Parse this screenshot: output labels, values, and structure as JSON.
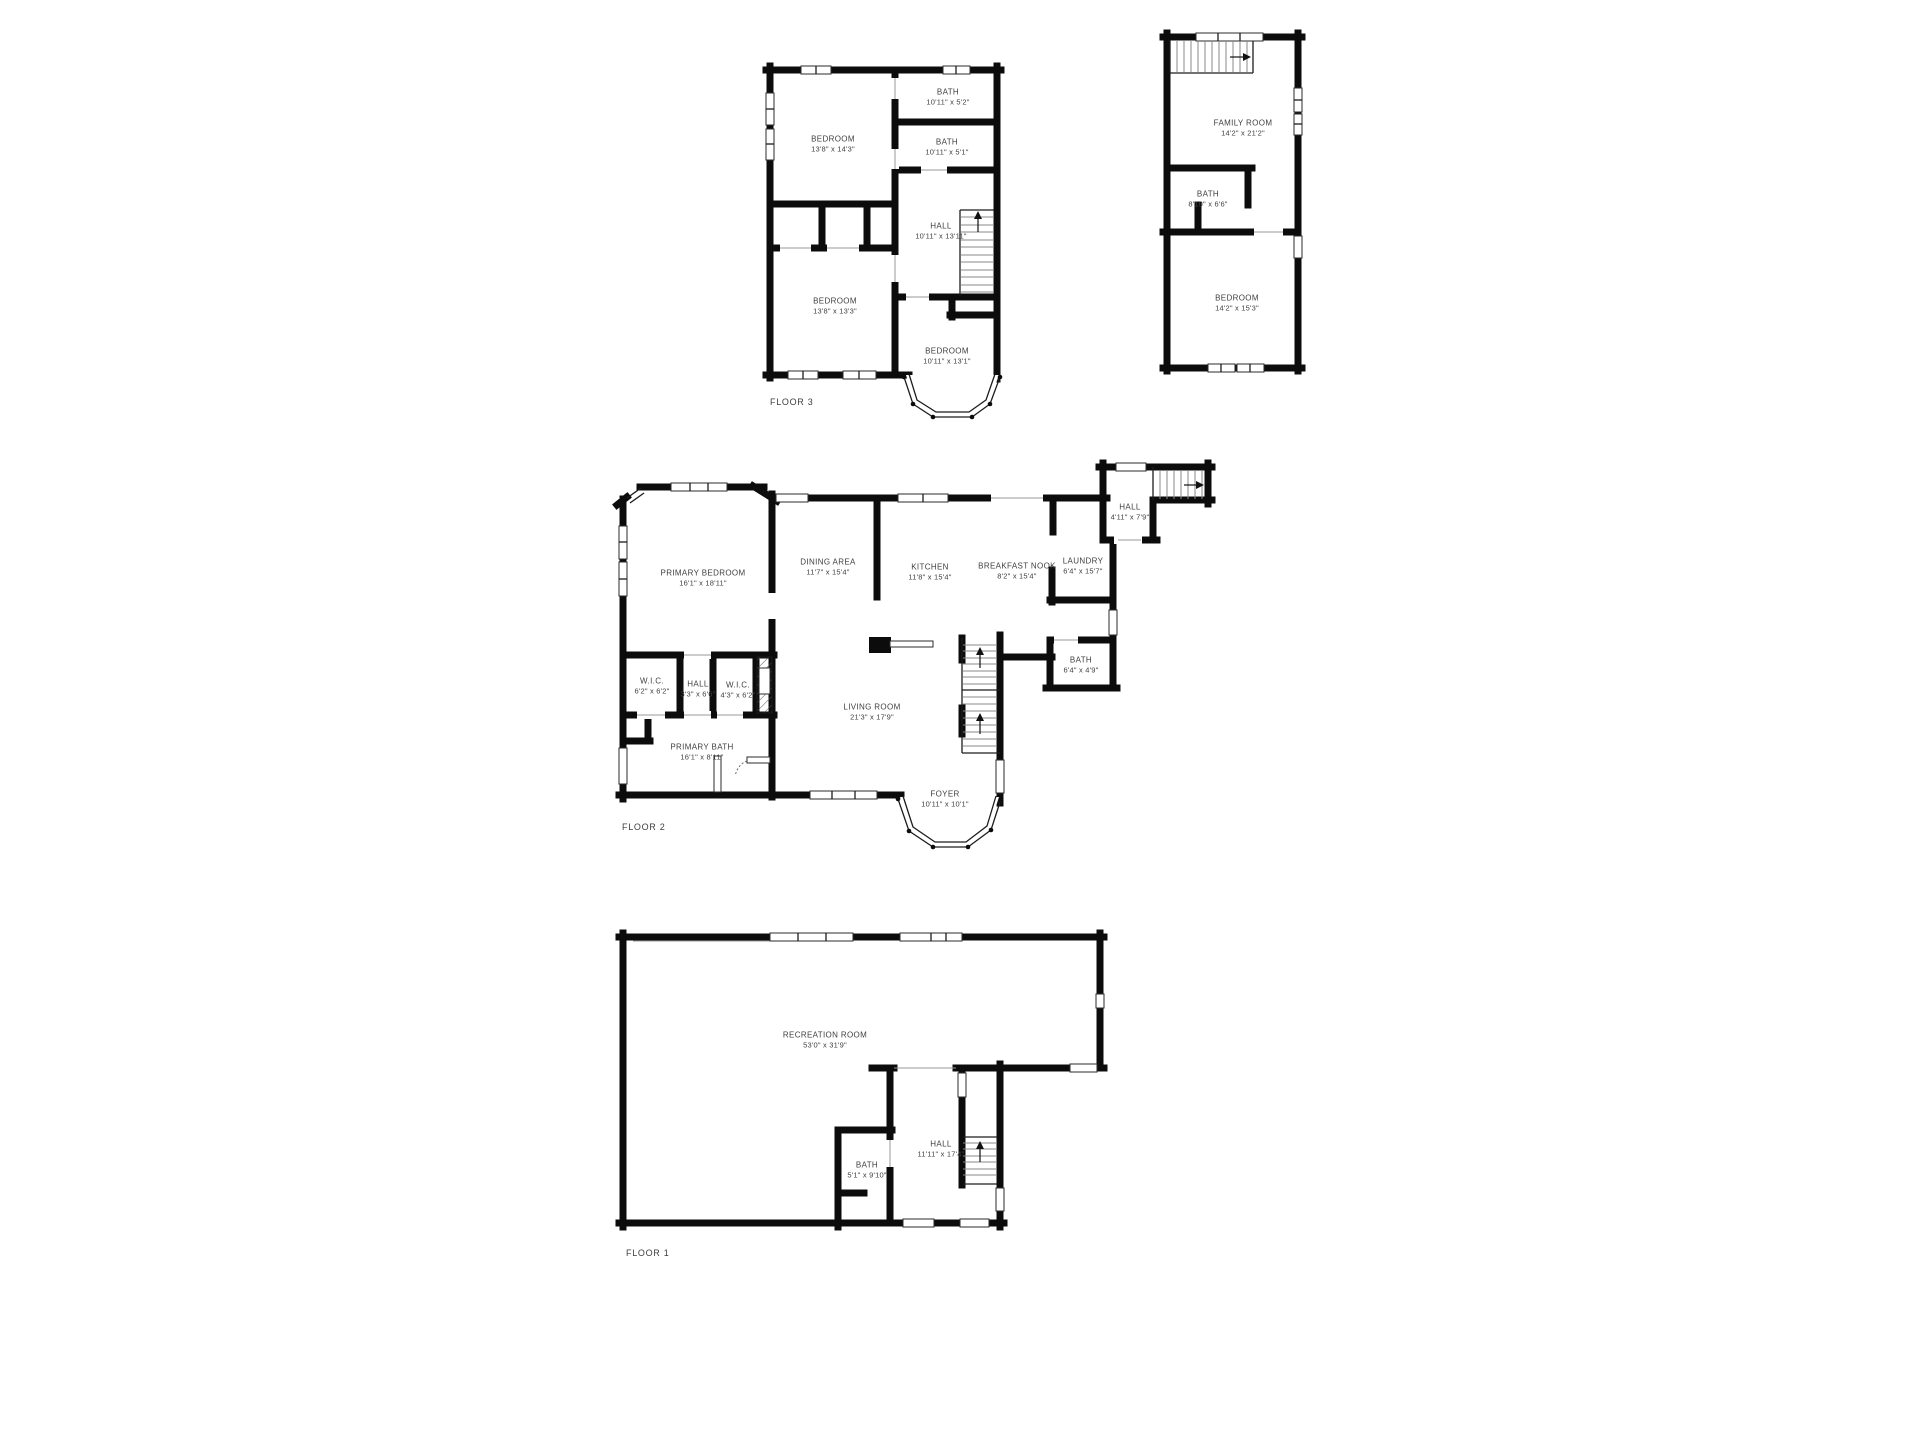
{
  "colors": {
    "background": "#ffffff",
    "walls": "#0c0c0c",
    "label_text": "#3f3f3f"
  },
  "floors": [
    {
      "title": "FLOOR 3",
      "rooms": [
        {
          "name": "BEDROOM",
          "dims": "13'8\" x 14'3\""
        },
        {
          "name": "BATH",
          "dims": "10'11\" x 5'2\""
        },
        {
          "name": "BATH",
          "dims": "10'11\" x 5'1\""
        },
        {
          "name": "HALL",
          "dims": "10'11\" x 13'11\""
        },
        {
          "name": "BEDROOM",
          "dims": "13'8\" x 13'3\""
        },
        {
          "name": "BEDROOM",
          "dims": "10'11\" x 13'1\""
        },
        {
          "name": "FAMILY ROOM",
          "dims": "14'2\" x 21'2\""
        },
        {
          "name": "BATH",
          "dims": "8'10\" x 6'6\""
        },
        {
          "name": "BEDROOM",
          "dims": "14'2\" x 15'3\""
        }
      ]
    },
    {
      "title": "FLOOR 2",
      "rooms": [
        {
          "name": "PRIMARY BEDROOM",
          "dims": "16'1\" x 18'11\""
        },
        {
          "name": "DINING AREA",
          "dims": "11'7\" x 15'4\""
        },
        {
          "name": "KITCHEN",
          "dims": "11'8\" x 15'4\""
        },
        {
          "name": "BREAKFAST NOOK",
          "dims": "8'2\" x 15'4\""
        },
        {
          "name": "LAUNDRY",
          "dims": "6'4\" x 15'7\""
        },
        {
          "name": "HALL",
          "dims": "4'11\" x 7'9\""
        },
        {
          "name": "BATH",
          "dims": "6'4\" x 4'9\""
        },
        {
          "name": "W.I.C.",
          "dims": "6'2\" x 6'2\""
        },
        {
          "name": "HALL",
          "dims": "3'3\" x 6'6\""
        },
        {
          "name": "W.I.C.",
          "dims": "4'3\" x 6'2\""
        },
        {
          "name": "LIVING ROOM",
          "dims": "21'3\" x 17'9\""
        },
        {
          "name": "PRIMARY BATH",
          "dims": "16'1\" x 8'11\""
        },
        {
          "name": "FOYER",
          "dims": "10'11\" x 10'1\""
        }
      ]
    },
    {
      "title": "FLOOR 1",
      "rooms": [
        {
          "name": "RECREATION ROOM",
          "dims": "53'0\" x 31'9\""
        },
        {
          "name": "BATH",
          "dims": "5'1\" x 9'10\""
        },
        {
          "name": "HALL",
          "dims": "11'11\" x 17'4\""
        }
      ]
    }
  ]
}
